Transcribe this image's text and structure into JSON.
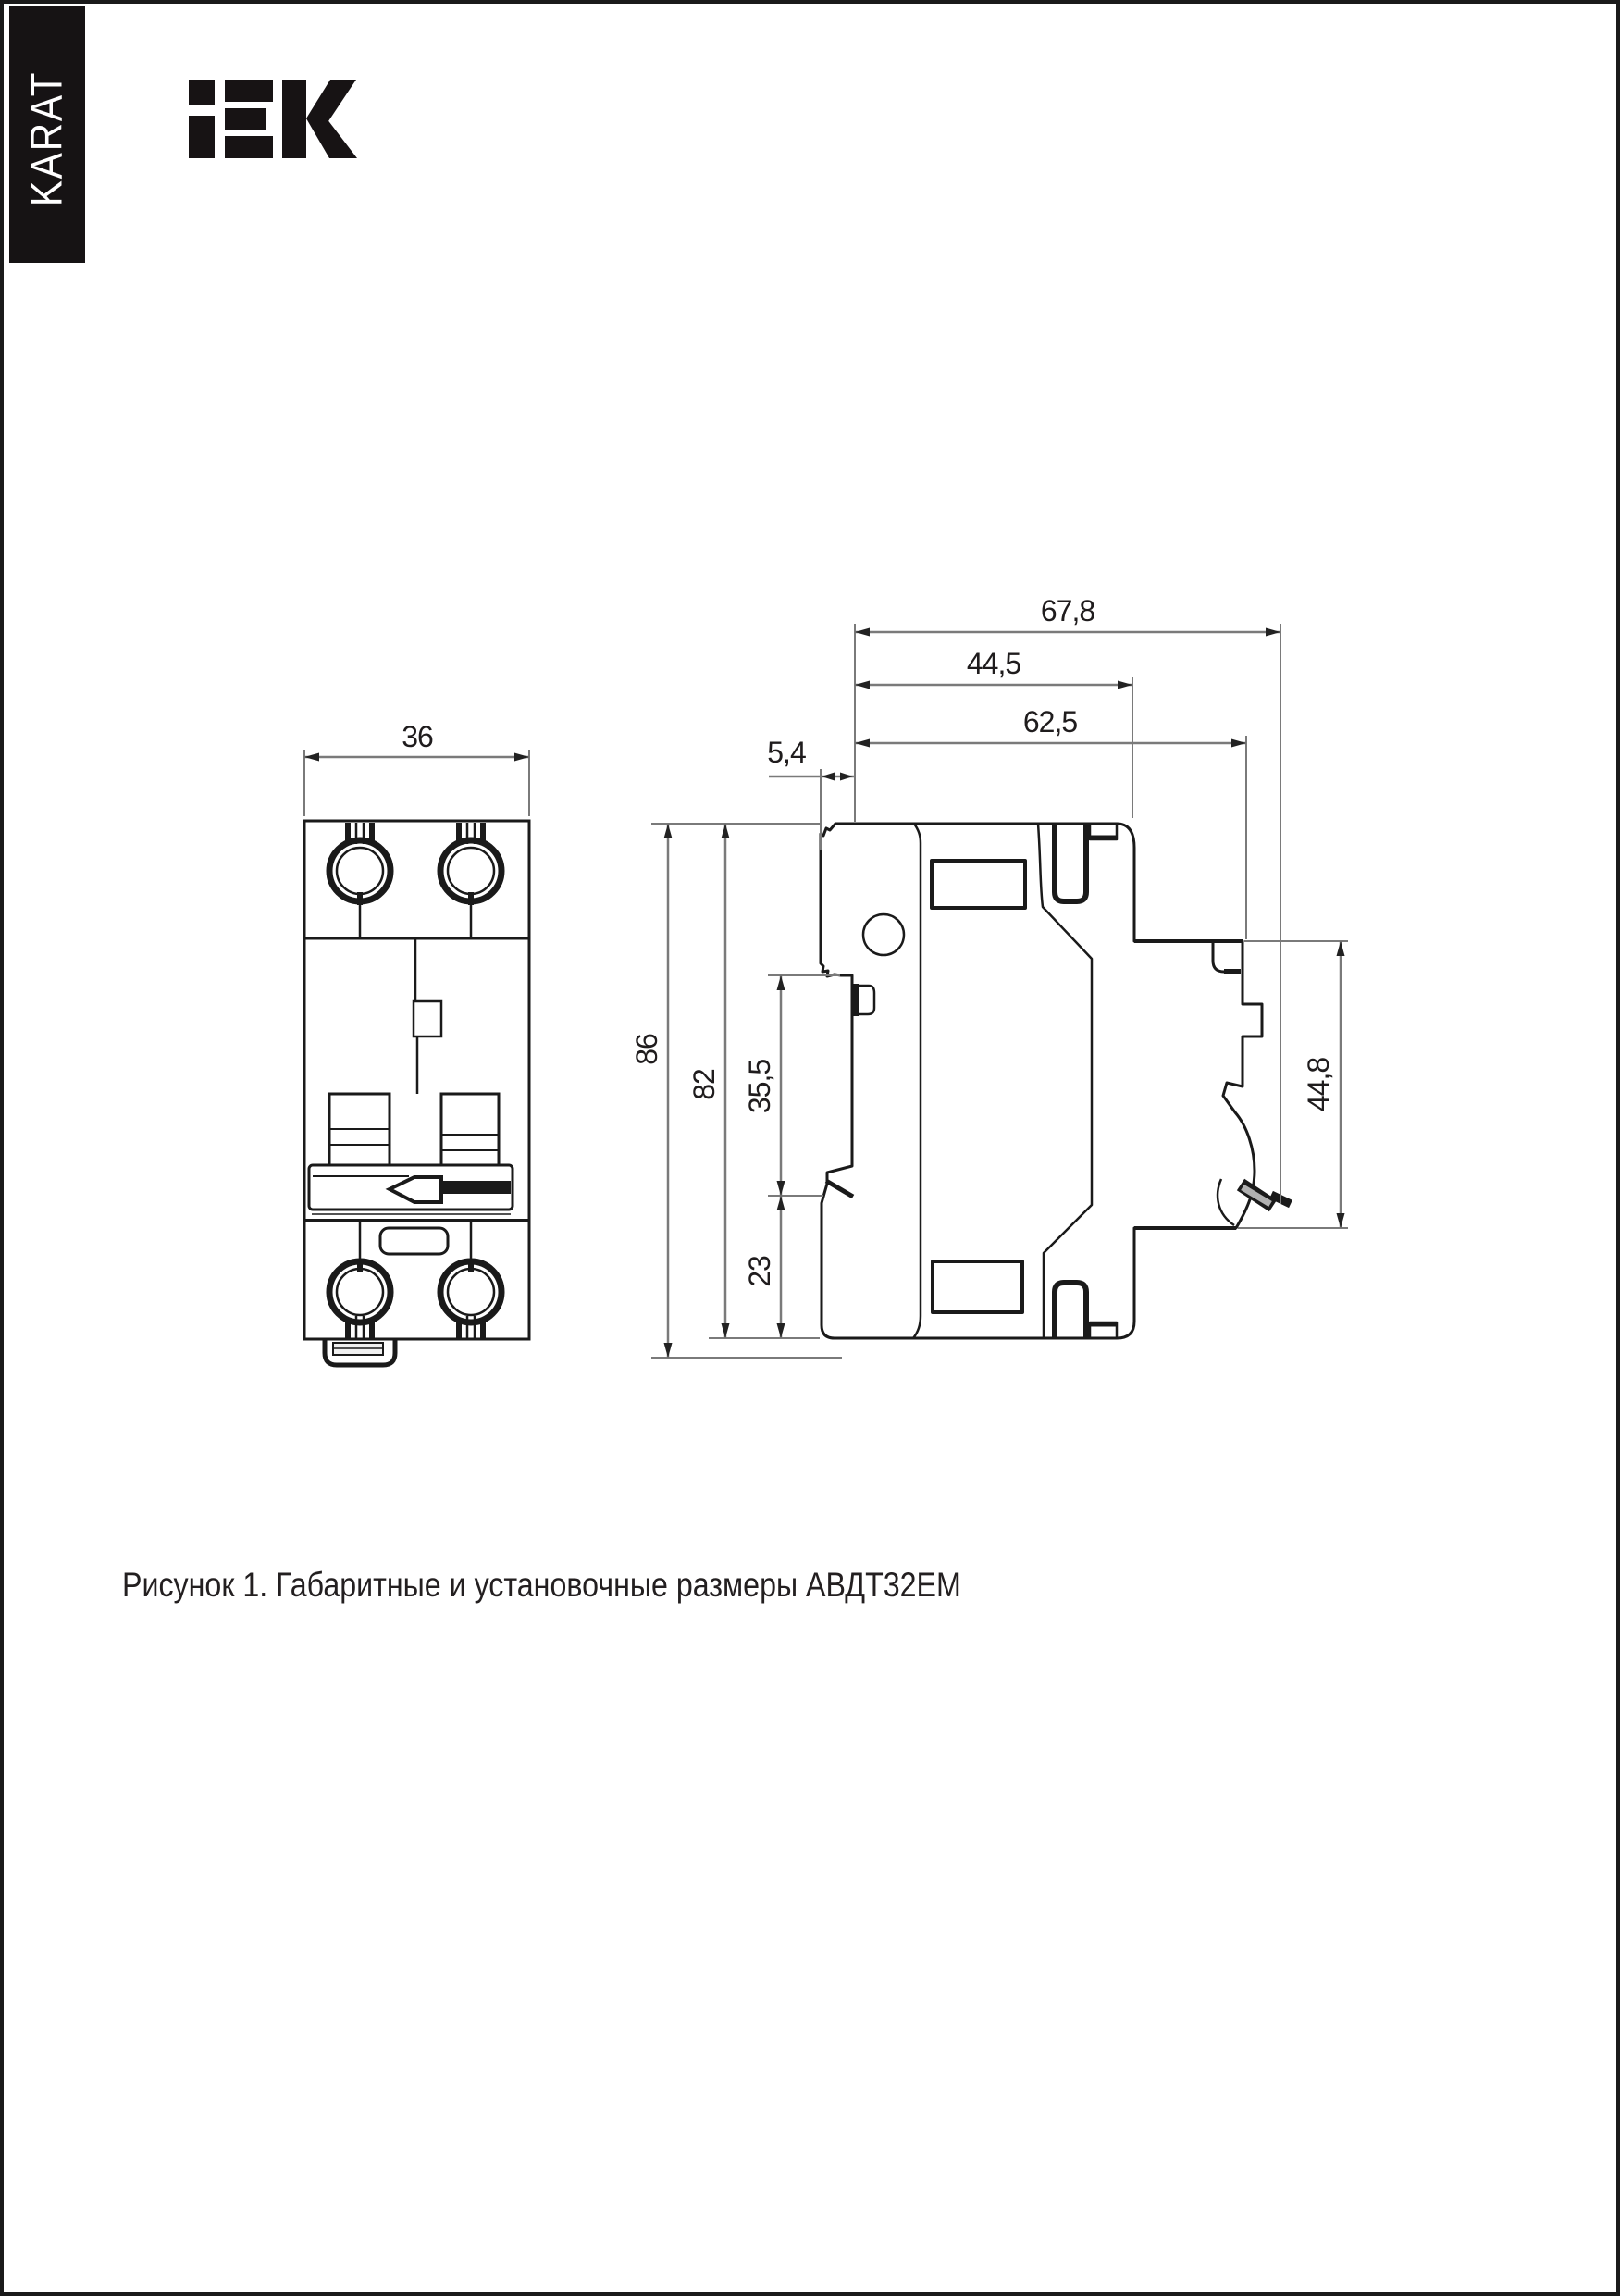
{
  "page": {
    "brand_vertical_label": "KARAT",
    "logo_text": "IEK",
    "caption": "Рисунок 1. Габаритные и установочные размеры АВДТ32ЕМ",
    "colors": {
      "line": "#1a1a1a",
      "dimension_line": "#7a7a7a",
      "brand_bar": "#161314",
      "background": "#ffffff"
    }
  },
  "figure": {
    "title": "АВДТ32ЕМ",
    "front_view": {
      "label": "front-view",
      "width_mm": "36"
    },
    "side_view": {
      "label": "side-view",
      "overall_depth_mm": "67,8",
      "body_depth_mm": "44,5",
      "din_depth_mm": "62,5",
      "front_lip_mm": "5,4",
      "overall_height_mm": "86",
      "body_height_mm": "82",
      "upper_section_mm": "35,5",
      "lower_section_mm": "23",
      "din_clamp_span_mm": "44,8"
    }
  }
}
